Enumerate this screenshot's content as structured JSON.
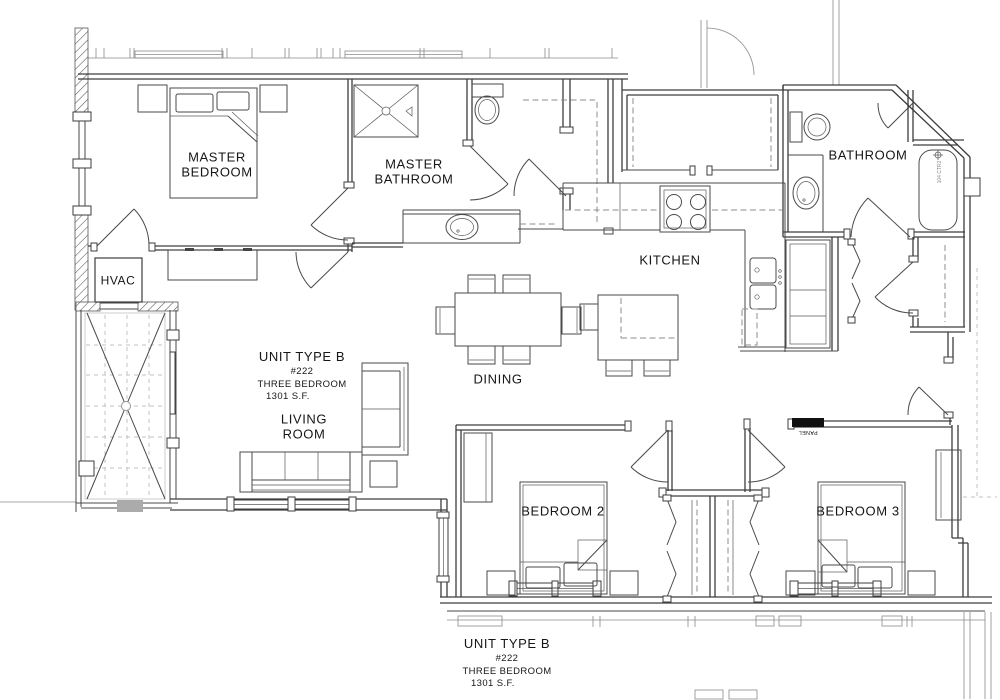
{
  "labels": {
    "master_bedroom": "MASTER BEDROOM",
    "master_bathroom": "MASTER BATHROOM",
    "bathroom": "BATHROOM",
    "kitchen": "KITCHEN",
    "dining": "DINING",
    "living_room": "LIVING ROOM",
    "bedroom_2": "BEDROOM 2",
    "bedroom_3": "BEDROOM 3",
    "hvac": "HVAC",
    "panel": "PANEL",
    "tub_tag": "104 CTR2"
  },
  "unit_info": {
    "name": "UNIT TYPE B",
    "number": "#222",
    "type": "THREE BEDROOM",
    "area": "1301 S.F."
  },
  "colors": {
    "line": "#3d3d3d",
    "light_line": "#c2c2c2",
    "panel_fill": "#111111",
    "background": "#ffffff"
  }
}
